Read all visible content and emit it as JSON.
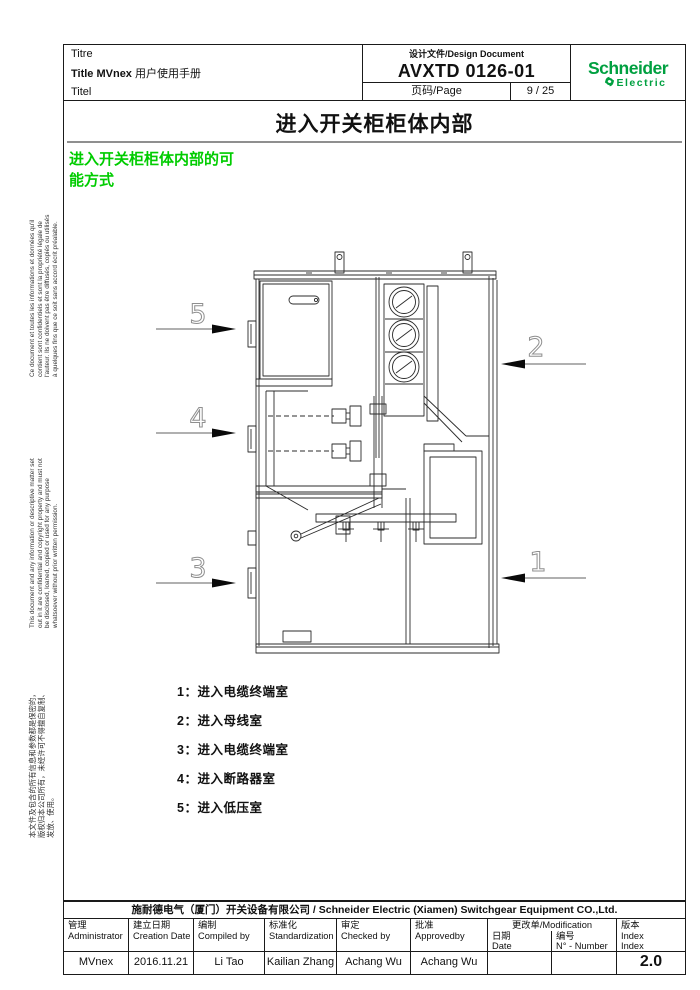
{
  "header": {
    "left": {
      "titre": "Titre",
      "title_prefix": "Title MVnex",
      "title_cn": " 用户使用手册",
      "titel": "Titel"
    },
    "doc": {
      "label": "设计文件/Design Document",
      "number": "AVXTD 0126-01",
      "page_label": "页码/Page",
      "page_value": "9 / 25"
    },
    "logo": {
      "line1": "Schneider",
      "line2": "Electric",
      "brand_color": "#00A040"
    }
  },
  "page_title": "进入开关柜柜体内部",
  "section_heading": {
    "text": "进入开关柜柜体内部的可\n能方式",
    "color": "#00cc00"
  },
  "side_notes": {
    "french": "Ce document et toutes les informations et données qu'il\ncontient sont confidentiels et sont la propriété légale de\nl'auteur. Ils ne doivent pas être diffusés, copiés ou utilisés\nà quelques fins que ce soit sans accord écrit préalable.",
    "english": "This document and any information or descriptive matter set\nout in it are confidential and copyright property and must not\nbe disclosed, loaned, copied or used for any purpose\nwhatsoever without prior written permission.",
    "chinese": "本文件及包含的所有信息和参数都是保密的，\n版权归本公司所有，未经许可不得擅自复制、\n发放、使用。"
  },
  "figure": {
    "callouts": [
      "1",
      "2",
      "3",
      "4",
      "5"
    ]
  },
  "legend": {
    "items": [
      "1：进入电缆终端室",
      "2：进入母线室",
      "3：进入电缆终端室",
      "4：进入断路器室",
      "5：进入低压室"
    ]
  },
  "footer": {
    "company": "施耐德电气（厦门）开关设备有限公司 / Schneider Electric  (Xiamen) Switchgear Equipment CO.,Ltd.",
    "cols": [
      {
        "cn": "管理",
        "en": "Administrator",
        "value": "MVnex"
      },
      {
        "cn": "建立日期",
        "en": "Creation Date",
        "value": "2016.11.21"
      },
      {
        "cn": "编制",
        "en": "Compiled by",
        "value": "Li Tao"
      },
      {
        "cn": "标准化",
        "en": "Standardization",
        "value": "Kailian Zhang"
      },
      {
        "cn": "审定",
        "en": "Checked by",
        "value": "Achang Wu"
      },
      {
        "cn": "批准",
        "en": "Approvedby",
        "value": "Achang Wu"
      }
    ],
    "modification": {
      "title": "更改单/Modification",
      "date_cn": "日期",
      "date_en": "Date",
      "num_cn": "编号",
      "num_en": "N° - Number",
      "date_value": "",
      "num_value": ""
    },
    "index": {
      "cn": "版本",
      "en1": "Index",
      "en2": "Index",
      "value": "2.0"
    }
  }
}
